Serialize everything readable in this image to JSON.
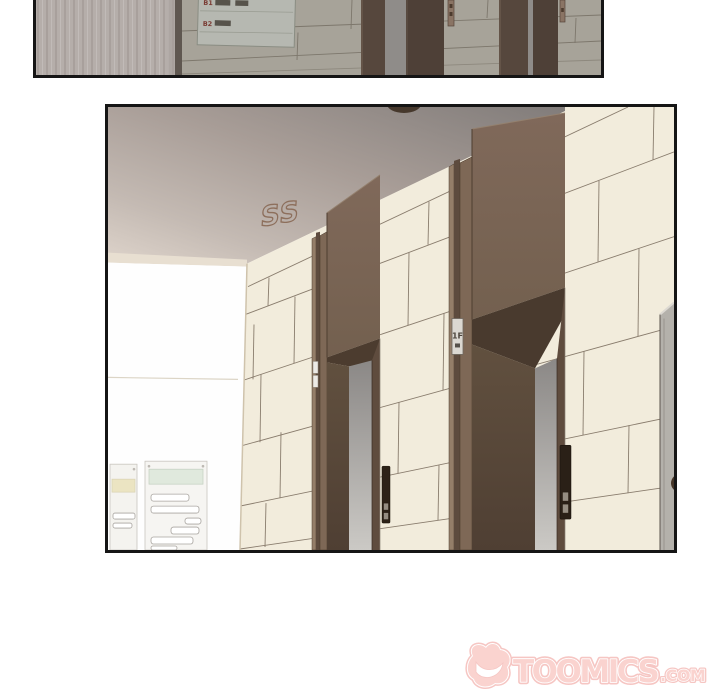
{
  "page": {
    "background": "#ffffff",
    "width": 720,
    "height": 700
  },
  "top_panel": {
    "directory_sign": {
      "rows": [
        {
          "label": "B1"
        },
        {
          "label": "B2"
        }
      ]
    }
  },
  "main_panel": {
    "ceiling_sfx": "SS",
    "door_plate_label": "1F"
  },
  "watermark": {
    "brand": "TOOMICS",
    "suffix": ".COM"
  },
  "colors": {
    "panel_border": "#151515",
    "cream_tile": "#f2ecdc",
    "tile_line": "#77695a",
    "door_brown": "#7e6856",
    "door_dark": "#4e3e31",
    "recess_grey": "#8b8886",
    "ceiling_grey": "#a89d97",
    "top_tile_grey": "#a7a399",
    "wood_wall": "#b5aeaa",
    "sign_label_red": "#7a3b33",
    "logo_pink": "#f6aba5",
    "logo_outline": "#ee938d"
  }
}
